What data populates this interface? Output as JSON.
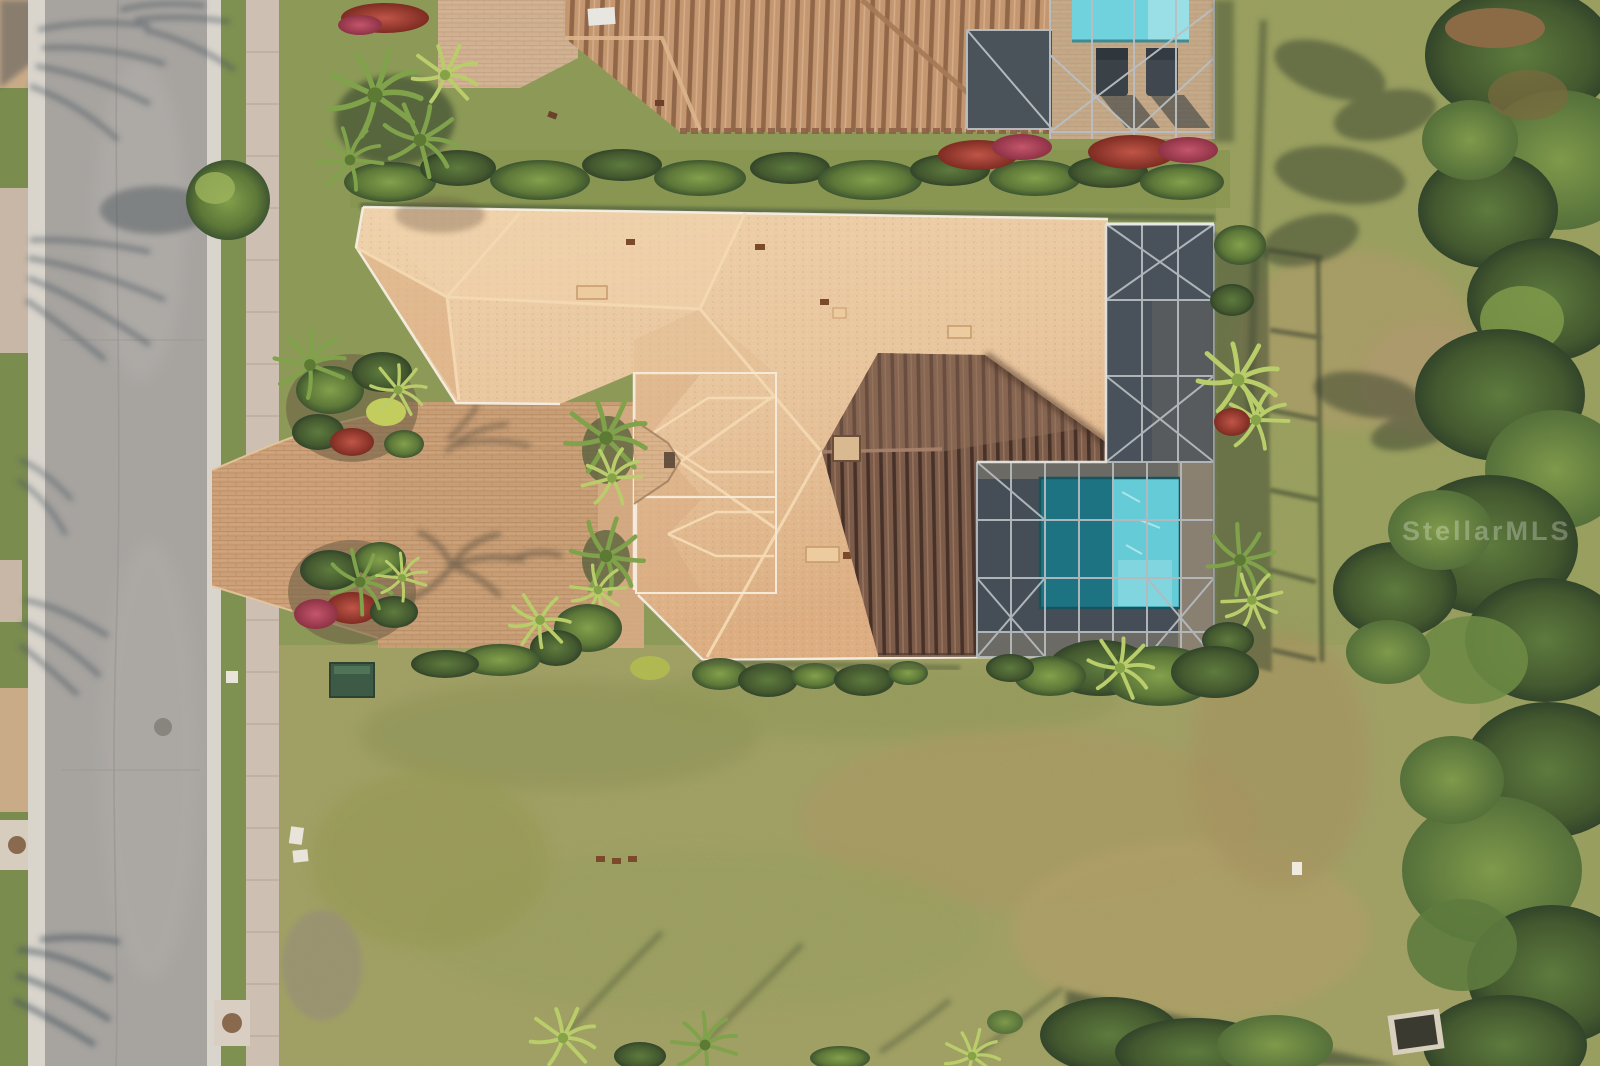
{
  "scene": {
    "type": "aerial-drone-photo",
    "description": "Overhead aerial view of a single-family Florida home with a tan flat-tile roof, dark standing-seam metal lanai roof, screened pool enclosure with turquoise pool, paver driveway and parking court, gray residential street with palm-tree shadows, neighbor house with barrel-tile roof and pool at top, large back lawn and a wooded tree line on the right"
  },
  "watermark": {
    "text": "StellarMLS"
  },
  "palette": {
    "road": "#a7a4a0",
    "curb": "#d9d5cd",
    "sidewalk": "#cdbfb2",
    "front_lawn": "#8a9654",
    "back_lawn": "#a2a165",
    "driveway_pavers": "#cb9f77",
    "tile_roof": "#e7c49c",
    "metal_roof": "#7d5b49",
    "neighbor_roof": "#c49770",
    "screen_enclosure": "#49525a",
    "enclosure_frame": "#b4babd",
    "pool_sunlit": "#67ccd8",
    "pool_shaded": "#1e7383",
    "pool_pale": "#9adfe6",
    "deck": "#b3a38b",
    "bush_dark": "#3e5530",
    "bush_light": "#87a04b",
    "palm_bright": "#a8bf62",
    "flower_red": "#a33b2e",
    "tree_canopy": "#445c33",
    "shadow_blue": "#46525e"
  }
}
